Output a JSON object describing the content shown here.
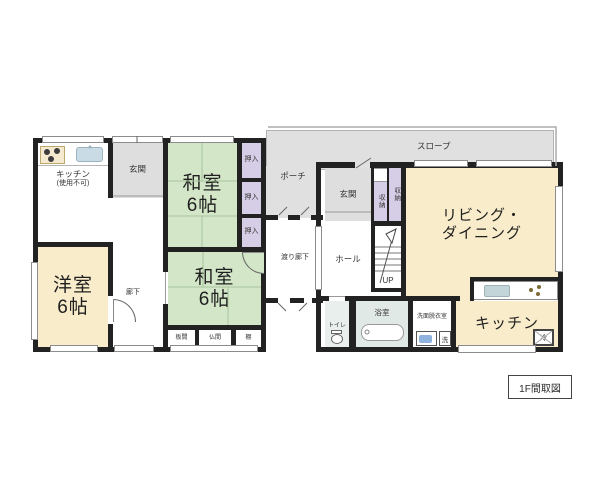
{
  "caption": "1F間取図",
  "labels": {
    "kitchen_unusable_line1": "キッチン",
    "kitchen_unusable_line2": "(使用不可)",
    "genkan_left": "玄関",
    "washitsu1_name": "和室",
    "washitsu1_size": "6帖",
    "oshiire_1": "押入",
    "oshiire_2": "押入",
    "oshiire_3": "押入",
    "porch": "ポーチ",
    "slope": "スロープ",
    "genkan_main": "玄関",
    "storage_1": "収納",
    "storage_2": "収納",
    "living_line1": "リビング・",
    "living_line2": "ダイニング",
    "hall": "ホール",
    "stairs_up": "UP",
    "crossing_corridor": "渡り廊下",
    "corridor": "廊下",
    "yoshitsu_name": "洋室",
    "yoshitsu_size": "6帖",
    "washitsu2_name": "和室",
    "washitsu2_size": "6帖",
    "itama": "板間",
    "butsuma": "仏間",
    "tana": "棚",
    "toilet": "トイレ",
    "bath": "浴室",
    "senmen": "洗面脱衣室",
    "washer": "洗",
    "fridge": "冷",
    "kitchen": "キッチン"
  },
  "colors": {
    "tatami_green": "#d4e6c8",
    "room_cream": "#f8ecca",
    "closet_purple": "#d6cee6",
    "entry_gray": "#dedede",
    "bath_tint": "#e1e9e7",
    "wall": "#222222"
  }
}
